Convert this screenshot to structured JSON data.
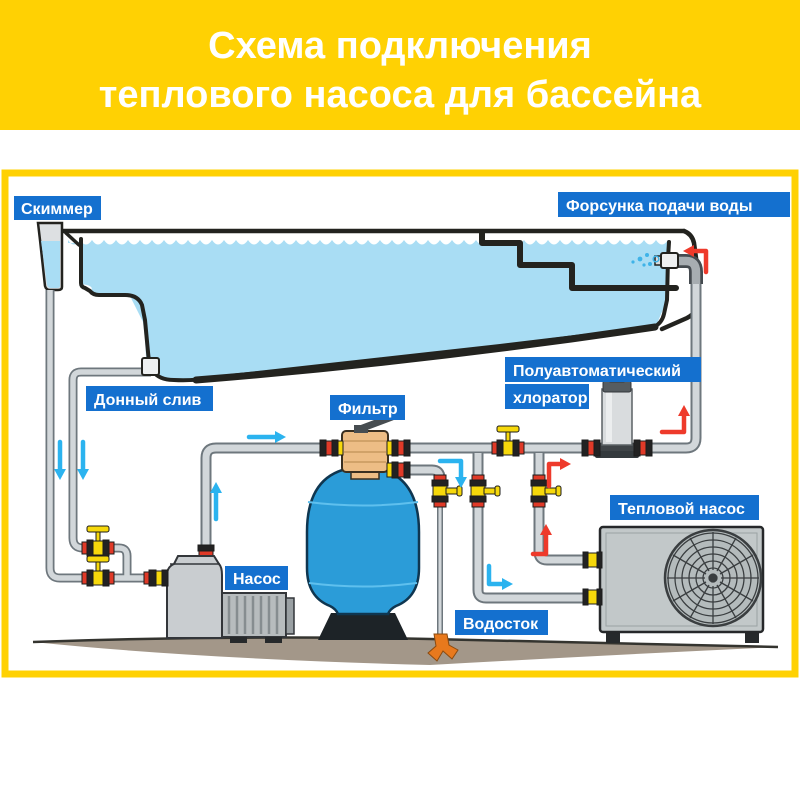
{
  "title": {
    "line1": "Схема подключения",
    "line2": "теплового насоса для бассейна"
  },
  "labels": {
    "skimmer": "Скиммер",
    "inlet_nozzle": "Форсунка подачи воды",
    "bottom_drain": "Донный слив",
    "filter": "Фильтр",
    "chlorinator_line1": "Полуавтоматический",
    "chlorinator_line2": "хлоратор",
    "heat_pump": "Тепловой насос",
    "pump": "Насос",
    "drain": "Водосток"
  },
  "colors": {
    "accent_yellow": "#ffd103",
    "label_blue": "#1470cf",
    "water_blue": "#a9ddf4",
    "tank_blue": "#2b9cd8",
    "pipe_gray": "#d2d7da",
    "valve_yellow": "#f6d80b",
    "union_red": "#e03a28",
    "arrow_blue": "#2bb3ef",
    "arrow_red": "#ee3a2b",
    "ground_brown": "#a39789",
    "drain_orange": "#e8791d"
  }
}
